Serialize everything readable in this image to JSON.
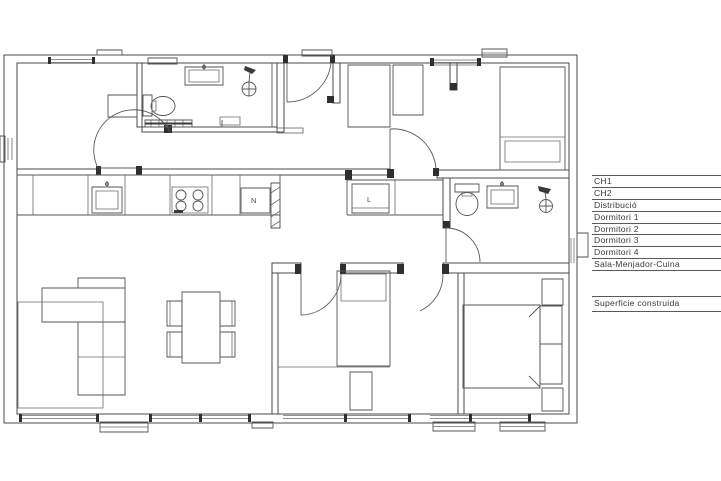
{
  "legend": {
    "rows": [
      "CH1",
      "CH2",
      "Distribució",
      "Dormitori 1",
      "Dormitori 2",
      "Dormitori 3",
      "Dormitori 4",
      "Sala-Menjador-Cuina"
    ],
    "footer": "Superficie construida"
  },
  "appliances": {
    "fridge_label": "N",
    "washer_label": "L"
  },
  "icons": [
    "toilet-icon",
    "sink-icon",
    "shower-icon",
    "stove-icon",
    "bed-icon",
    "sofa-icon",
    "dining-table-icon",
    "door-arc"
  ],
  "colors": {
    "wall": "#4a4a4a",
    "fixture": "#555555",
    "legend_line": "#5a5a5a",
    "text": "#3a3a3a",
    "background": "#ffffff"
  }
}
